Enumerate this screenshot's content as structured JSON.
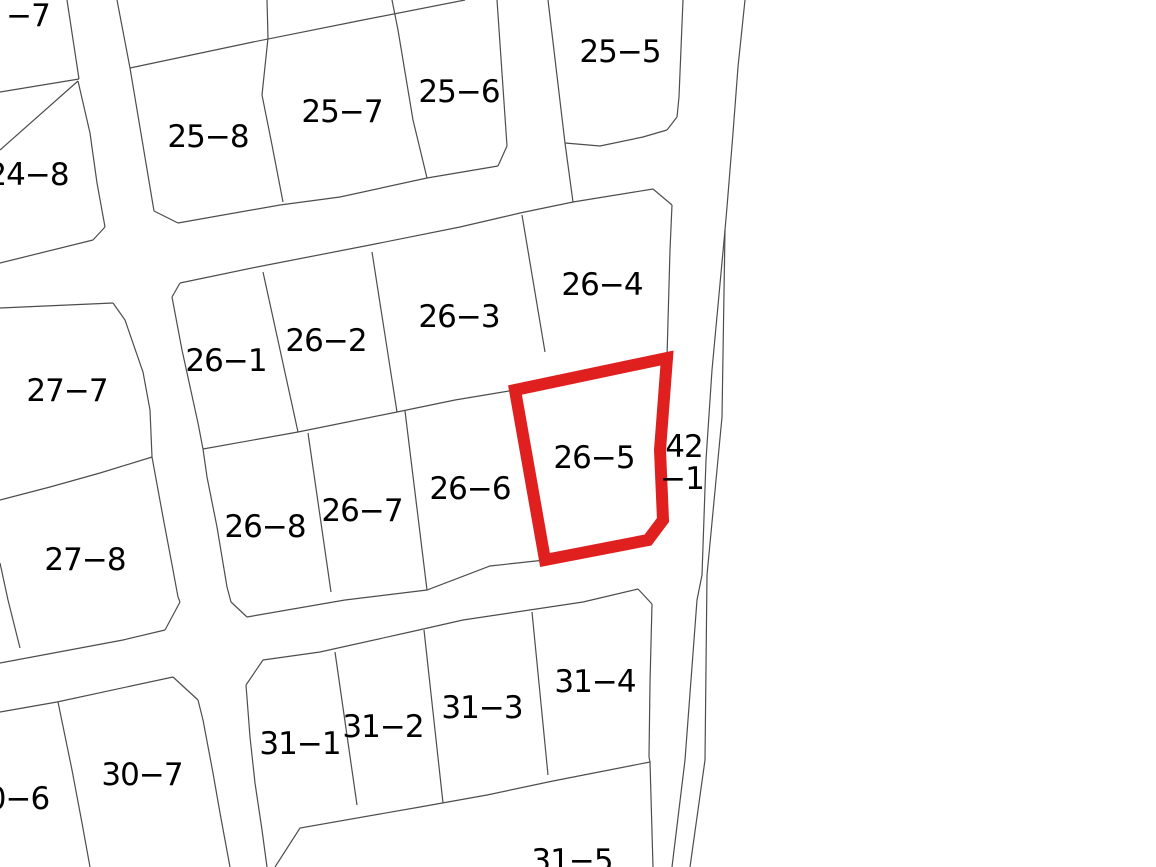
{
  "map": {
    "type": "cadastral-parcel-map",
    "background_color": "#ffffff",
    "boundary_line_color": "#4d4d4d",
    "boundary_line_width": 1.2,
    "label_font_size": 31,
    "highlighted_parcel": {
      "label": "26−5",
      "outline_color": "#e01f1f",
      "outline_width": 12,
      "points": "515,390 667,358 660,450 663,520 648,540 545,560"
    },
    "labels": [
      {
        "text": "−7",
        "x": 28,
        "y": 16
      },
      {
        "text": "24−8",
        "x": 28,
        "y": 175
      },
      {
        "text": "25−8",
        "x": 208,
        "y": 137
      },
      {
        "text": "25−7",
        "x": 342,
        "y": 112
      },
      {
        "text": "25−6",
        "x": 459,
        "y": 92
      },
      {
        "text": "25−5",
        "x": 620,
        "y": 52
      },
      {
        "text": "26−1",
        "x": 226,
        "y": 361
      },
      {
        "text": "26−2",
        "x": 326,
        "y": 341
      },
      {
        "text": "26−3",
        "x": 459,
        "y": 317
      },
      {
        "text": "26−4",
        "x": 602,
        "y": 285
      },
      {
        "text": "26−5",
        "x": 594,
        "y": 458
      },
      {
        "text": "26−6",
        "x": 470,
        "y": 489
      },
      {
        "text": "26−7",
        "x": 362,
        "y": 511
      },
      {
        "text": "26−8",
        "x": 265,
        "y": 527
      },
      {
        "text": "27−7",
        "x": 67,
        "y": 391
      },
      {
        "text": "27−8",
        "x": 85,
        "y": 560
      },
      {
        "text": "42",
        "x": 684,
        "y": 447
      },
      {
        "text": "−1",
        "x": 682,
        "y": 479
      },
      {
        "text": "30−7",
        "x": 142,
        "y": 775
      },
      {
        "text": "0−6",
        "x": 18,
        "y": 799
      },
      {
        "text": "31−1",
        "x": 300,
        "y": 744
      },
      {
        "text": "31−2",
        "x": 383,
        "y": 727
      },
      {
        "text": "31−3",
        "x": 482,
        "y": 708
      },
      {
        "text": "31−4",
        "x": 595,
        "y": 682
      },
      {
        "text": "31−5",
        "x": 572,
        "y": 861
      }
    ],
    "boundaries": [
      {
        "name": "parcel-7-right-edge",
        "points": "67,0 79,79"
      },
      {
        "name": "parcel-7-bottom-edge",
        "points": "79,79 0,92"
      },
      {
        "name": "parcel-24-8-top-edge",
        "points": "0,150 78,81"
      },
      {
        "name": "parcel-24-8-right-edge",
        "points": "78,81 90,133 97,183 105,227"
      },
      {
        "name": "parcel-24-8-corner-chamfer",
        "points": "105,227 93,240"
      },
      {
        "name": "parcel-24-8-bottom-edge",
        "points": "93,240 0,263"
      },
      {
        "name": "block25-upper-row-boundary",
        "points": "130,68 253,42 363,20 465,0"
      },
      {
        "name": "parcel-25-8-left-edge",
        "points": "117,0 130,68 154,211"
      },
      {
        "name": "parcel-25-8-corner-chamfer",
        "points": "154,211 178,223"
      },
      {
        "name": "road-upper-north-edge",
        "points": "178,223 280,205 340,197 427,178 498,166"
      },
      {
        "name": "divider-25-8-25-7",
        "points": "267,0 268,38 262,95 272,145 283,202"
      },
      {
        "name": "divider-25-7-25-6",
        "points": "392,0 398,30 413,120 427,178"
      },
      {
        "name": "parcel-25-6-corner-chamfer",
        "points": "498,166 507,146"
      },
      {
        "name": "parcel-25-6-right-edge",
        "points": "507,146 497,0"
      },
      {
        "name": "parcel-25-5-left-edge",
        "points": "548,0 565,143"
      },
      {
        "name": "parcel-25-5-west-connector",
        "points": "565,143 573,202"
      },
      {
        "name": "parcel-25-5-bottom-edge",
        "points": "565,143 600,146 643,137 667,130"
      },
      {
        "name": "parcel-25-5-corner-chamfer",
        "points": "667,130 677,117"
      },
      {
        "name": "parcel-25-5-right-edge",
        "points": "677,117 679,97 683,0"
      },
      {
        "name": "road-east-upper-line",
        "points": "745,0 738,67 733,133 727,207 725,230"
      },
      {
        "name": "road-east-west-branch",
        "points": "725,230 712,370 706,460 702,575 697,600 685,760 672,867"
      },
      {
        "name": "road-east-east-branch",
        "points": "725,230 722,417 707,575 705,760 690,867"
      },
      {
        "name": "block26-top-edge",
        "points": "653,189 573,202 520,213 503,217 460,227 370,245 257,267 180,283"
      },
      {
        "name": "block26-topleft-chamfer",
        "points": "180,283 172,297"
      },
      {
        "name": "block26-left-edge-upper",
        "points": "172,297 182,350 198,423 203,449"
      },
      {
        "name": "block26-left-edge-lower",
        "points": "203,449 207,477 217,527 227,587 231,602"
      },
      {
        "name": "block26-botleft-chamfer",
        "points": "231,602 247,617"
      },
      {
        "name": "block26-bottom-edge",
        "points": "247,617 345,600 427,590 490,566 545,560"
      },
      {
        "name": "parcel-26-4-corner-chamfer",
        "points": "653,189 672,205"
      },
      {
        "name": "parcel-26-4-right-edge",
        "points": "672,205 670,250 667,357"
      },
      {
        "name": "block26-row-divider",
        "points": "203,449 298,432 397,412 455,400 515,390"
      },
      {
        "name": "divider-26-1-26-2",
        "points": "263,272 298,432"
      },
      {
        "name": "divider-26-2-26-3",
        "points": "372,252 397,412"
      },
      {
        "name": "divider-26-3-26-4",
        "points": "522,215 545,352"
      },
      {
        "name": "divider-26-8-26-7",
        "points": "308,433 331,592"
      },
      {
        "name": "divider-26-7-26-6",
        "points": "405,411 427,590"
      },
      {
        "name": "block27-top-edge",
        "points": "0,308 113,303"
      },
      {
        "name": "block27-corner-chamfer",
        "points": "113,303 125,320"
      },
      {
        "name": "parcel-27-7-right-edge",
        "points": "125,320 143,372 150,410 152,457"
      },
      {
        "name": "divider-27-7-27-8",
        "points": "152,457 100,473 50,487 0,500"
      },
      {
        "name": "parcel-27-8-right-edge",
        "points": "152,457 163,517 173,570 178,597 180,602"
      },
      {
        "name": "parcel-27-8-corner-chamfer",
        "points": "180,602 165,630"
      },
      {
        "name": "parcel-27-8-bottom-edge",
        "points": "165,630 123,640 0,663"
      },
      {
        "name": "west-edge-boundary-stub",
        "points": "0,563 8,600 20,648"
      },
      {
        "name": "block30-top-edge",
        "points": "0,712 57,702 173,677"
      },
      {
        "name": "parcel-30-7-corner-chamfer",
        "points": "173,677 198,700"
      },
      {
        "name": "parcel-30-7-right-edge",
        "points": "198,700 203,720 213,773 220,813 230,867"
      },
      {
        "name": "divider-30-6-30-7",
        "points": "58,702 72,770 82,823 90,867"
      },
      {
        "name": "block31-left-edge",
        "points": "246,685 250,737 255,783 262,830 267,867"
      },
      {
        "name": "block31-topleft-chamfer",
        "points": "246,685 263,660"
      },
      {
        "name": "block31-top-edge",
        "points": "263,660 320,652 410,632 463,620 583,602 638,589"
      },
      {
        "name": "parcel-31-4-corner-chamfer",
        "points": "638,589 652,604"
      },
      {
        "name": "parcel-31-4-right-edge",
        "points": "652,604 650,683 649,757 650,762"
      },
      {
        "name": "parcel-31-5-right-edge",
        "points": "650,762 653,867"
      },
      {
        "name": "block31-row-divider",
        "points": "650,762 553,781 487,795 420,807 300,828 275,867"
      },
      {
        "name": "divider-31-1-31-2",
        "points": "335,652 357,805"
      },
      {
        "name": "divider-31-2-31-3",
        "points": "424,630 443,803"
      },
      {
        "name": "divider-31-3-31-4",
        "points": "532,612 548,775"
      }
    ]
  }
}
